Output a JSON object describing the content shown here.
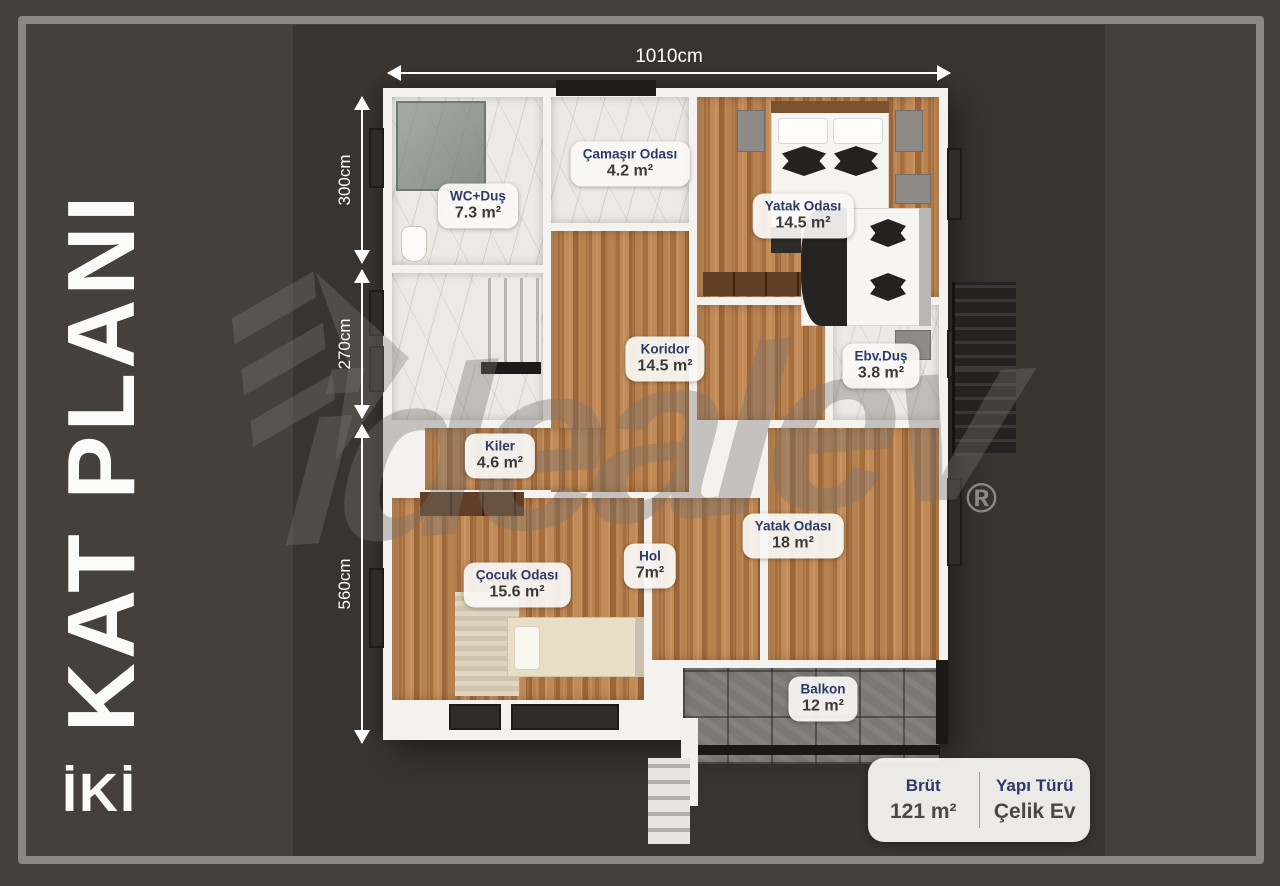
{
  "page": {
    "title_vertical": "KAT PLANI",
    "subtitle": "İKİ"
  },
  "watermark": {
    "text": "idealev",
    "registered": "®"
  },
  "dimensions": {
    "top": "1010cm",
    "left": [
      "300cm",
      "270cm",
      "560cm"
    ]
  },
  "rooms": [
    {
      "id": "wc-dus",
      "name": "WC+Duş",
      "area": "7.3 m²"
    },
    {
      "id": "camasir-odasi",
      "name": "Çamaşır Odası",
      "area": "4.2 m²"
    },
    {
      "id": "yatak-odasi-1",
      "name": "Yatak Odası",
      "area": "14.5 m²"
    },
    {
      "id": "koridor",
      "name": "Koridor",
      "area": "14.5 m²"
    },
    {
      "id": "ebv-dus",
      "name": "Ebv.Duş",
      "area": "3.8 m²"
    },
    {
      "id": "kiler",
      "name": "Kiler",
      "area": "4.6 m²"
    },
    {
      "id": "cocuk-odasi",
      "name": "Çocuk Odası",
      "area": "15.6 m²"
    },
    {
      "id": "hol",
      "name": "Hol",
      "area": "7m²"
    },
    {
      "id": "yatak-odasi-2",
      "name": "Yatak Odası",
      "area": "18 m²"
    },
    {
      "id": "balkon",
      "name": "Balkon",
      "area": "12 m²"
    }
  ],
  "info_box": {
    "left_label": "Brüt",
    "left_value": "121 m²",
    "right_label": "Yapı Türü",
    "right_value": "Çelik Ev"
  },
  "colors": {
    "background": "#46403c",
    "render_bg": "#39342f",
    "frame": "#8b8884",
    "label_text": "#2c3a6a",
    "wood_floor": "#b07a48",
    "marble_floor": "#edeae6",
    "balcony_stone": "#7b7876",
    "wall": "#f4f2ef"
  }
}
